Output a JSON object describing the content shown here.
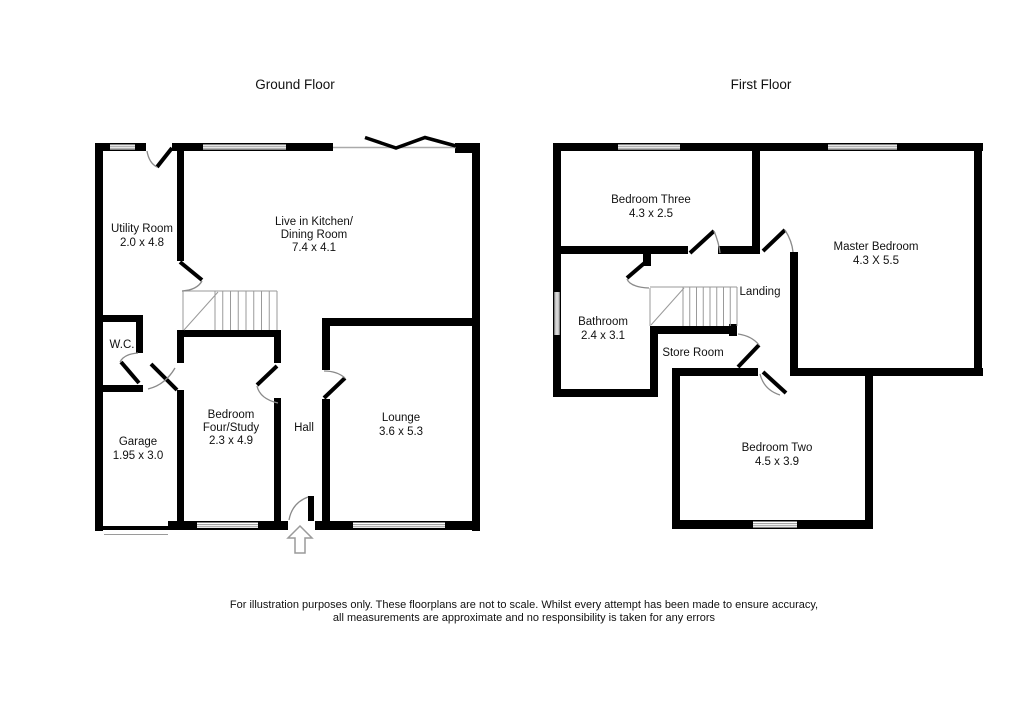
{
  "ground_floor": {
    "title": "Ground Floor",
    "rooms": {
      "utility": {
        "lines": [
          "Utility Room",
          "2.0 x 4.8"
        ]
      },
      "kitchen": {
        "lines": [
          "Live in Kitchen/",
          "Dining Room",
          "7.4 x 4.1"
        ]
      },
      "wc": {
        "lines": [
          "W.C."
        ]
      },
      "garage": {
        "lines": [
          "Garage",
          "1.95 x 3.0"
        ]
      },
      "bedroom_four": {
        "lines": [
          "Bedroom",
          "Four/Study",
          "2.3 x 4.9"
        ]
      },
      "hall": {
        "lines": [
          "Hall"
        ]
      },
      "lounge": {
        "lines": [
          "Lounge",
          "3.6 x 5.3"
        ]
      }
    }
  },
  "first_floor": {
    "title": "First Floor",
    "rooms": {
      "bedroom_three": {
        "lines": [
          "Bedroom Three",
          "4.3 x 2.5"
        ]
      },
      "master": {
        "lines": [
          "Master Bedroom",
          "4.3 X 5.5"
        ]
      },
      "landing": {
        "lines": [
          "Landing"
        ]
      },
      "bathroom": {
        "lines": [
          "Bathroom",
          "2.4 x 3.1"
        ]
      },
      "store": {
        "lines": [
          "Store Room"
        ]
      },
      "bedroom_two": {
        "lines": [
          "Bedroom Two",
          "4.5 x 3.9"
        ]
      }
    }
  },
  "disclaimer": {
    "line1": "For illustration purposes only. These floorplans are not to scale. Whilst every attempt has been made to ensure accuracy,",
    "line2": "all measurements are approximate and no responsibility is taken for any errors"
  },
  "colors": {
    "wall": "#000000",
    "thin_line": "#9a9a9a",
    "text": "#111111",
    "background": "#ffffff"
  }
}
